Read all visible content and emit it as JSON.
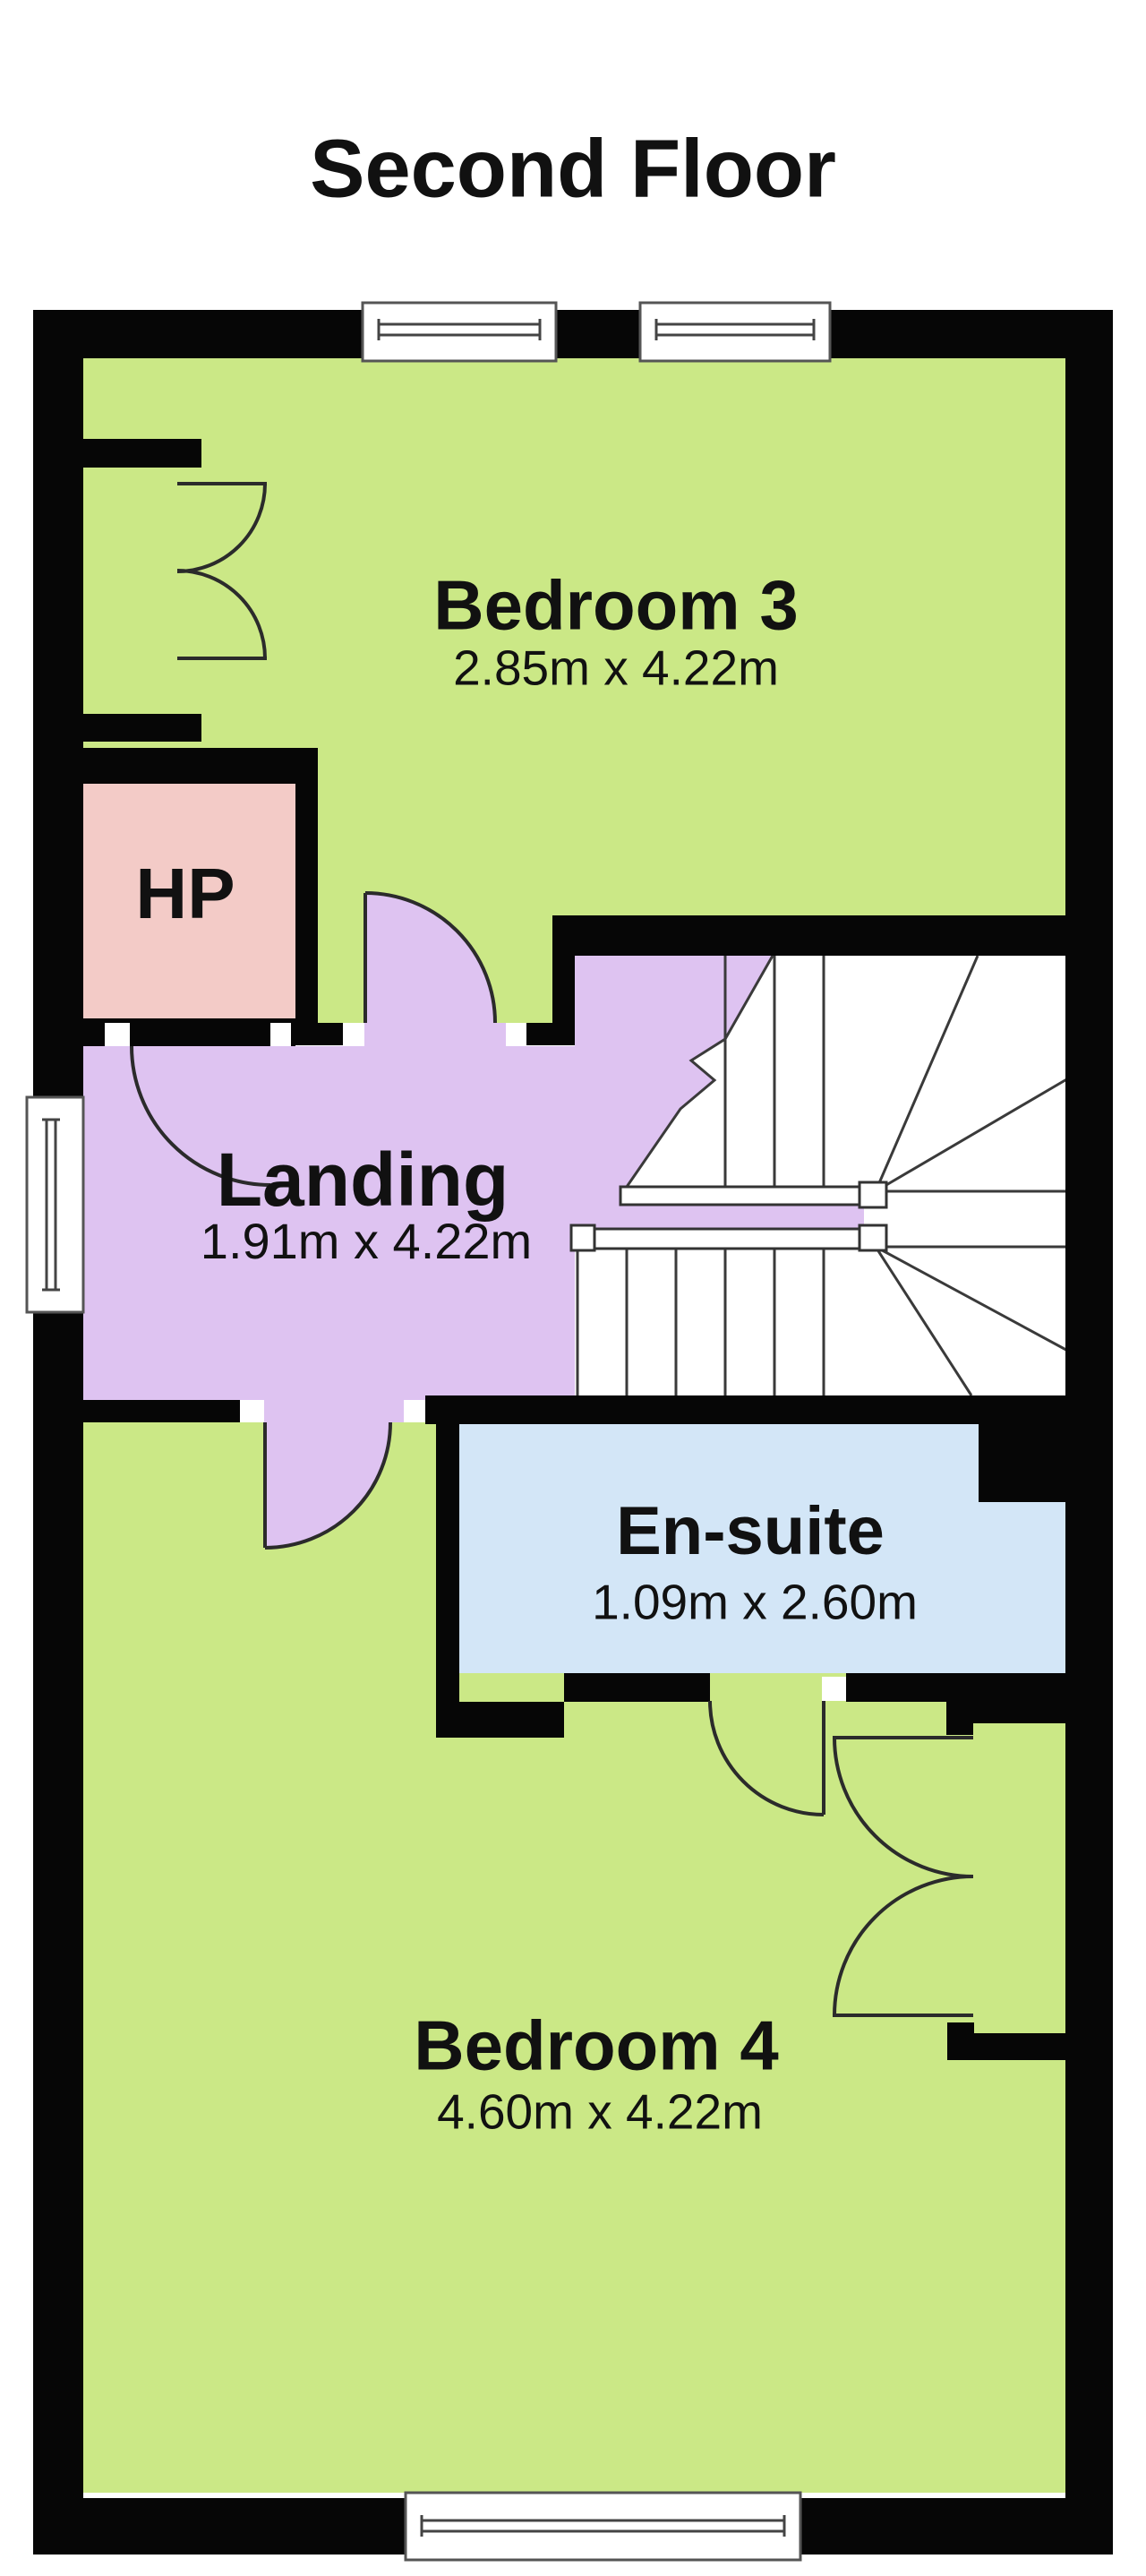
{
  "title": "Second Floor",
  "colors": {
    "room_green": "#CBE886",
    "landing_purple": "#DEC3F1",
    "hp_pink": "#F3CBC7",
    "ensuite_blue": "#D3E6F7",
    "wall": "#060606",
    "line": "#2b2b2b",
    "stair_line": "#3a3a3a"
  },
  "rooms": {
    "bedroom3": {
      "name": "Bedroom 3",
      "dims": "2.85m x 4.22m"
    },
    "hp": {
      "name": "HP"
    },
    "landing": {
      "name": "Landing",
      "dims": "1.91m x 4.22m"
    },
    "ensuite": {
      "name": "En-suite",
      "dims": "1.09m x 2.60m"
    },
    "bedroom4": {
      "name": "Bedroom 4",
      "dims": "4.60m x 4.22m"
    }
  }
}
